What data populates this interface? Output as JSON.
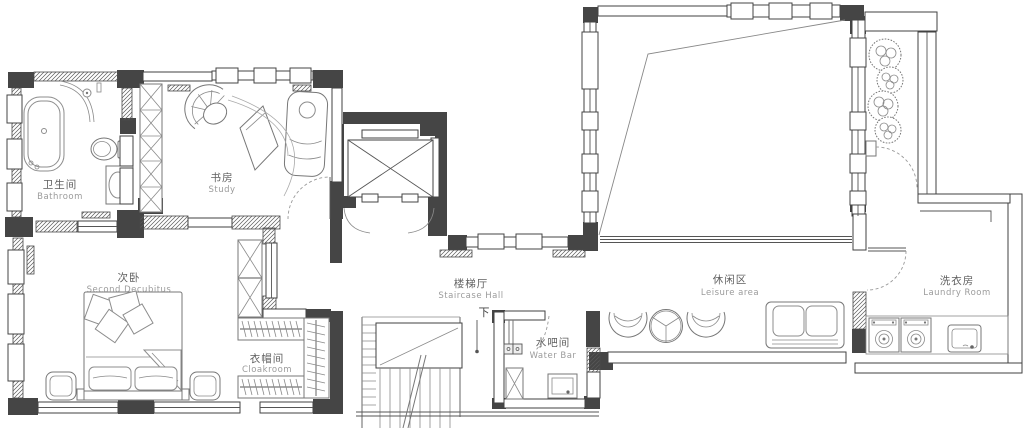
{
  "plan": {
    "rooms": {
      "bathroom": {
        "zh": "卫生间",
        "en": "Bathroom"
      },
      "study": {
        "zh": "书房",
        "en": "Study"
      },
      "second_bedroom": {
        "zh": "次卧",
        "en": "Second Decubitus"
      },
      "cloakroom": {
        "zh": "衣帽间",
        "en": "Cloakroom"
      },
      "staircase_hall": {
        "zh": "楼梯厅",
        "en": "Staircase Hall"
      },
      "water_bar": {
        "zh": "水吧间",
        "en": "Water Bar"
      },
      "leisure_area": {
        "zh": "休闲区",
        "en": "Leisure area"
      },
      "laundry_room": {
        "zh": "洗衣房",
        "en": "Laundry Room"
      }
    },
    "annotations": {
      "stairs_down": "下"
    },
    "colors": {
      "wall": "#454545",
      "hatch_line": "#5a5a5a",
      "furniture": "#8c8c8c",
      "door_arc": "#9a9a9a",
      "label_zh": "#5f5f5f",
      "label_en": "#9b9b9b",
      "background": "#ffffff"
    }
  }
}
